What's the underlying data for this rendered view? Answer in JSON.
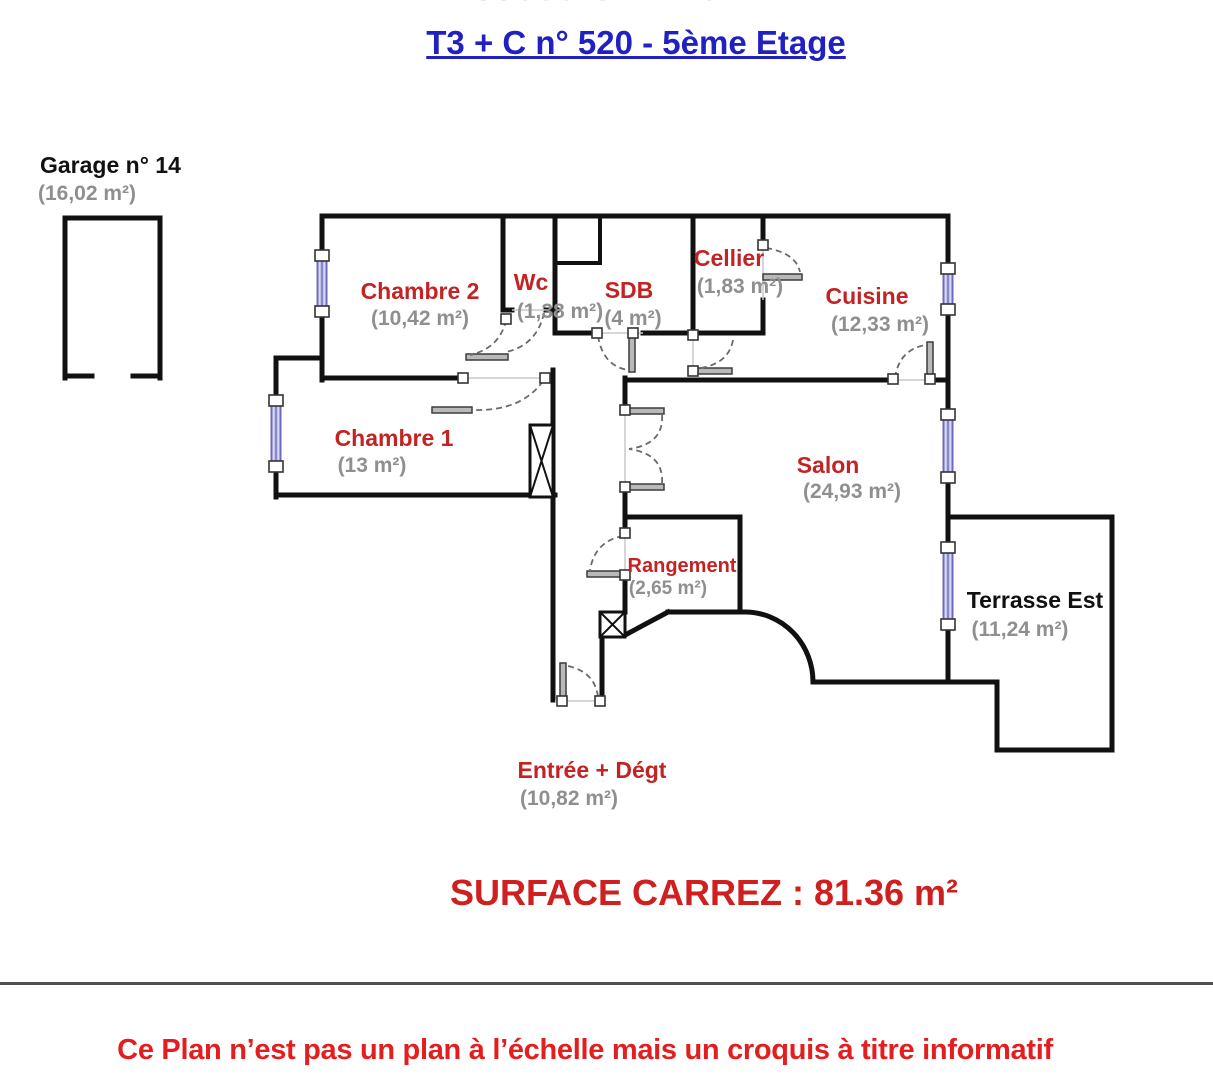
{
  "page": {
    "clipped_top_line": "38000 GRENOBLE",
    "title": "T3 + C n° 520 - 5ème Etage",
    "surface_carrez": "SURFACE CARREZ : 81.36 m²",
    "disclaimer": "Ce Plan n’est pas un plan à l’échelle mais un croquis à titre informatif"
  },
  "garage": {
    "name": "Garage n° 14",
    "area": "(16,02 m²)"
  },
  "rooms": {
    "chambre2": {
      "name": "Chambre 2",
      "area": "(10,42 m²)"
    },
    "wc": {
      "name": "Wc",
      "area": "(1,38 m²)"
    },
    "sdb": {
      "name": "SDB",
      "area": "(4 m²)"
    },
    "cellier": {
      "name": "Cellier",
      "area": "(1,83 m²)"
    },
    "cuisine": {
      "name": "Cuisine",
      "area": "(12,33 m²)"
    },
    "chambre1": {
      "name": "Chambre 1",
      "area": "(13 m²)"
    },
    "salon": {
      "name": "Salon",
      "area": "(24,93 m²)"
    },
    "rangement": {
      "name": "Rangement",
      "area": "(2,65 m²)"
    },
    "terrasse": {
      "name": "Terrasse Est",
      "area": "(11,24 m²)"
    },
    "entree": {
      "name": "Entrée + Dégt",
      "area": "(10,82 m²)"
    }
  },
  "colors": {
    "room_label_red": "#c32323",
    "area_grey": "#8f8f8f",
    "title_blue": "#2121c2",
    "surface_red": "#cf1f1f",
    "disclaimer_red": "#e41e1e",
    "wall_black": "#111111",
    "window_blue": "#8787cf",
    "shaft_grey": "#8a8a8a"
  }
}
